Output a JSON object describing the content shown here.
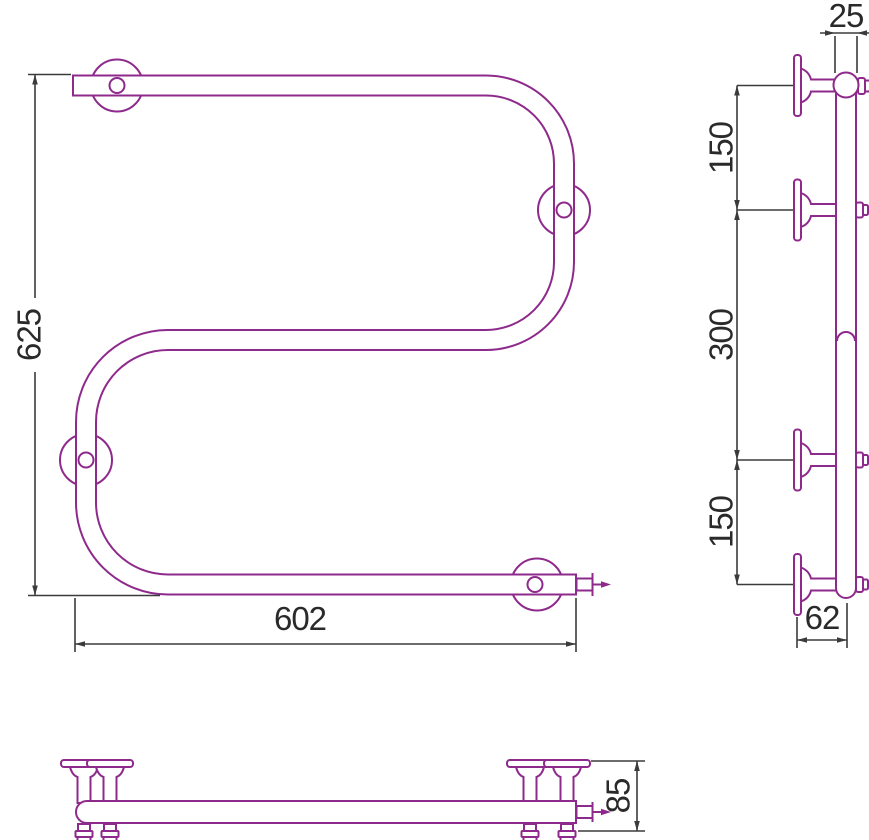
{
  "drawing": {
    "type": "technical-drawing",
    "subject": "S-shaped towel rail with wall brackets, three orthographic views"
  },
  "colors": {
    "drawing": "#8E2A8B",
    "dimension": "#3B3B3B",
    "text": "#2A2A2A",
    "background": "#FFFFFF"
  },
  "dimensions": {
    "front_height": "625",
    "front_width": "602",
    "pipe_diameter": "25",
    "side_spacing_top": "150",
    "side_spacing_middle": "300",
    "side_spacing_bottom": "150",
    "side_bracket_depth": "62",
    "plan_depth": "85"
  }
}
